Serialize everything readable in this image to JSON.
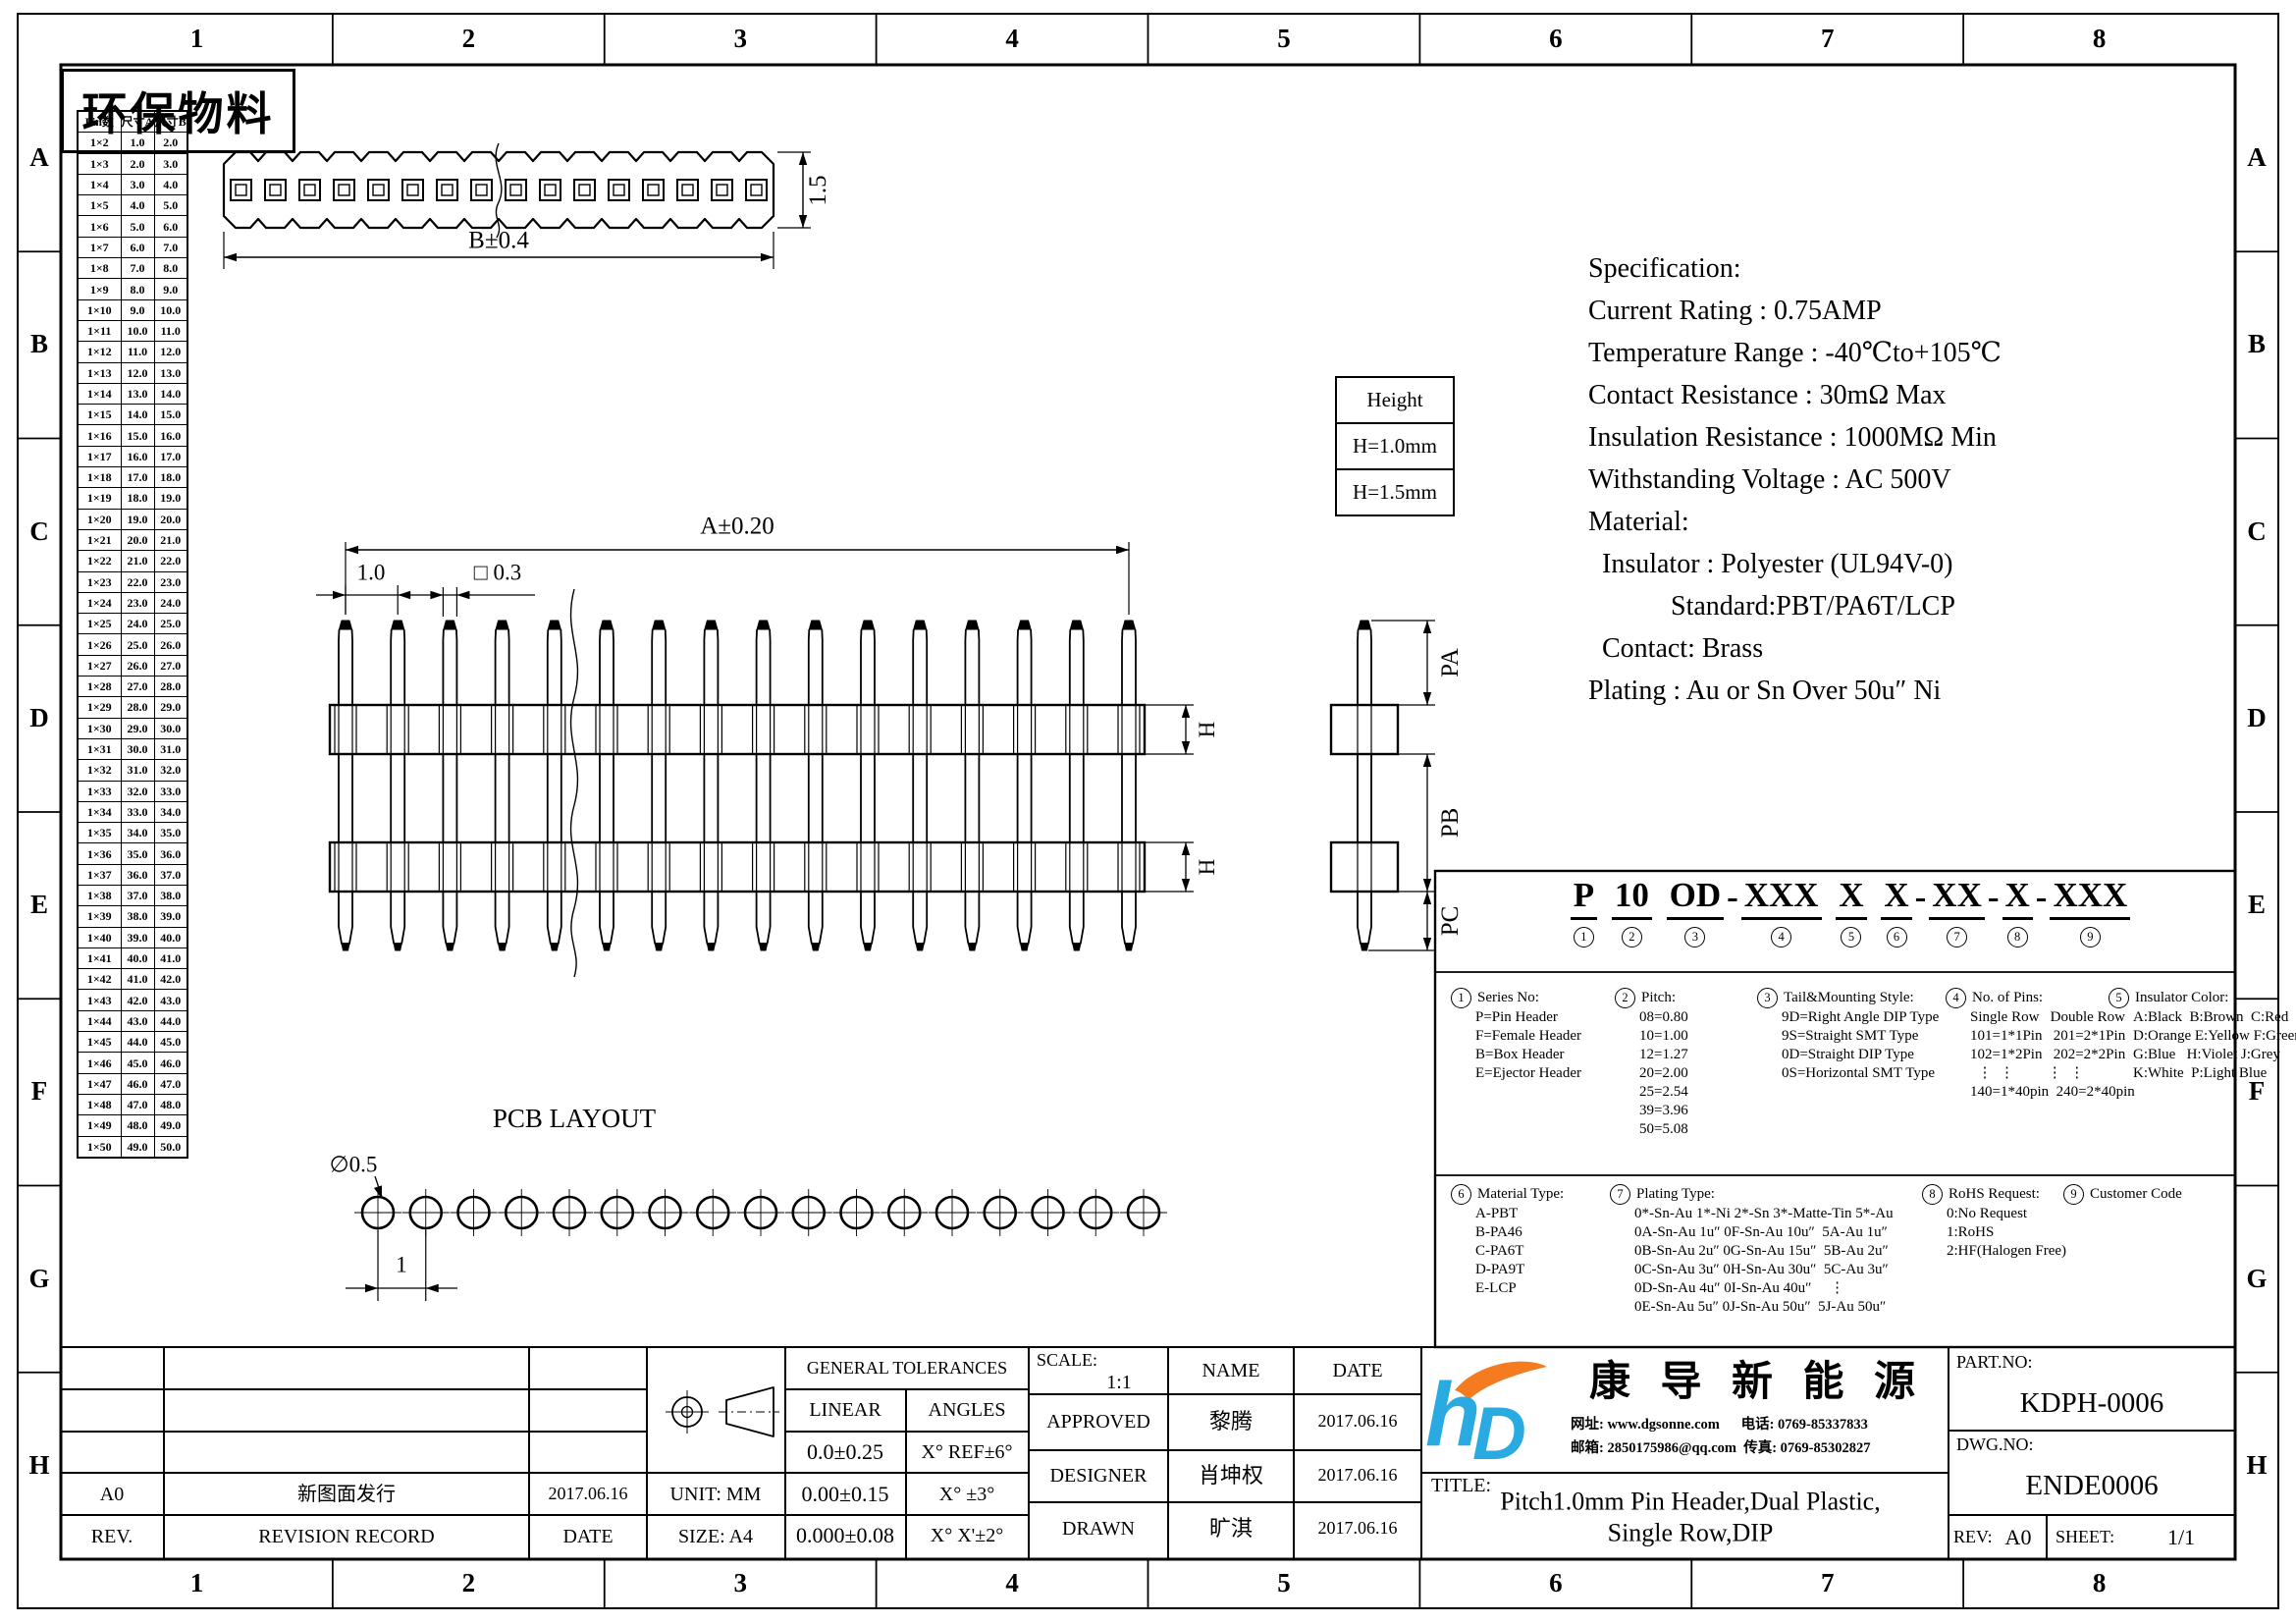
{
  "sheet": {
    "eco_label": "环保物料",
    "zone_cols": [
      "1",
      "2",
      "3",
      "4",
      "5",
      "6",
      "7",
      "8"
    ],
    "zone_rows": [
      "A",
      "B",
      "C",
      "D",
      "E",
      "F",
      "G",
      "H"
    ]
  },
  "dimension_table": {
    "headers": [
      "Pin数",
      "尺寸A",
      "尺寸B"
    ],
    "rows": [
      [
        "1×2",
        "1.0",
        "2.0"
      ],
      [
        "1×3",
        "2.0",
        "3.0"
      ],
      [
        "1×4",
        "3.0",
        "4.0"
      ],
      [
        "1×5",
        "4.0",
        "5.0"
      ],
      [
        "1×6",
        "5.0",
        "6.0"
      ],
      [
        "1×7",
        "6.0",
        "7.0"
      ],
      [
        "1×8",
        "7.0",
        "8.0"
      ],
      [
        "1×9",
        "8.0",
        "9.0"
      ],
      [
        "1×10",
        "9.0",
        "10.0"
      ],
      [
        "1×11",
        "10.0",
        "11.0"
      ],
      [
        "1×12",
        "11.0",
        "12.0"
      ],
      [
        "1×13",
        "12.0",
        "13.0"
      ],
      [
        "1×14",
        "13.0",
        "14.0"
      ],
      [
        "1×15",
        "14.0",
        "15.0"
      ],
      [
        "1×16",
        "15.0",
        "16.0"
      ],
      [
        "1×17",
        "16.0",
        "17.0"
      ],
      [
        "1×18",
        "17.0",
        "18.0"
      ],
      [
        "1×19",
        "18.0",
        "19.0"
      ],
      [
        "1×20",
        "19.0",
        "20.0"
      ],
      [
        "1×21",
        "20.0",
        "21.0"
      ],
      [
        "1×22",
        "21.0",
        "22.0"
      ],
      [
        "1×23",
        "22.0",
        "23.0"
      ],
      [
        "1×24",
        "23.0",
        "24.0"
      ],
      [
        "1×25",
        "24.0",
        "25.0"
      ],
      [
        "1×26",
        "25.0",
        "26.0"
      ],
      [
        "1×27",
        "26.0",
        "27.0"
      ],
      [
        "1×28",
        "27.0",
        "28.0"
      ],
      [
        "1×29",
        "28.0",
        "29.0"
      ],
      [
        "1×30",
        "29.0",
        "30.0"
      ],
      [
        "1×31",
        "30.0",
        "31.0"
      ],
      [
        "1×32",
        "31.0",
        "32.0"
      ],
      [
        "1×33",
        "32.0",
        "33.0"
      ],
      [
        "1×34",
        "33.0",
        "34.0"
      ],
      [
        "1×35",
        "34.0",
        "35.0"
      ],
      [
        "1×36",
        "35.0",
        "36.0"
      ],
      [
        "1×37",
        "36.0",
        "37.0"
      ],
      [
        "1×38",
        "37.0",
        "38.0"
      ],
      [
        "1×39",
        "38.0",
        "39.0"
      ],
      [
        "1×40",
        "39.0",
        "40.0"
      ],
      [
        "1×41",
        "40.0",
        "41.0"
      ],
      [
        "1×42",
        "41.0",
        "42.0"
      ],
      [
        "1×43",
        "42.0",
        "43.0"
      ],
      [
        "1×44",
        "43.0",
        "44.0"
      ],
      [
        "1×45",
        "44.0",
        "45.0"
      ],
      [
        "1×46",
        "45.0",
        "46.0"
      ],
      [
        "1×47",
        "46.0",
        "47.0"
      ],
      [
        "1×48",
        "47.0",
        "48.0"
      ],
      [
        "1×49",
        "48.0",
        "49.0"
      ],
      [
        "1×50",
        "49.0",
        "50.0"
      ]
    ]
  },
  "height_table": {
    "title": "Height",
    "rows": [
      "H=1.0mm",
      "H=1.5mm"
    ]
  },
  "top_view": {
    "dim_width": "B±0.4",
    "dim_height": "1.5"
  },
  "front_view": {
    "dim_overall": "A±0.20",
    "dim_pitch": "1.0",
    "dim_pin": "□ 0.3",
    "dim_h": "H"
  },
  "side_view": {
    "pa": "PA",
    "pb": "PB",
    "pc": "PC"
  },
  "pcb_layout": {
    "title": "PCB LAYOUT",
    "hole_dia": "∅0.5",
    "hole_pitch": "1"
  },
  "spec": {
    "lines": [
      "Specification:",
      "Current Rating : 0.75AMP",
      "Temperature Range : -40℃to+105℃",
      "Contact Resistance : 30mΩ Max",
      "Insulation Resistance : 1000MΩ Min",
      "Withstanding Voltage : AC 500V",
      "Material:",
      "  Insulator : Polyester (UL94V-0)",
      "            Standard:PBT/PA6T/LCP",
      "  Contact: Brass",
      "Plating : Au or Sn Over 50u″ Ni"
    ]
  },
  "part_number": {
    "segments": [
      {
        "t": "P",
        "n": "1"
      },
      {
        "t": "10",
        "n": "2",
        "pre": " "
      },
      {
        "t": "OD",
        "n": "3",
        "pre": " "
      },
      {
        "t": "XXX",
        "n": "4",
        "pre": "-"
      },
      {
        "t": "X",
        "n": "5",
        "pre": " "
      },
      {
        "t": "X",
        "n": "6",
        "pre": " "
      },
      {
        "t": "XX",
        "n": "7",
        "pre": "-"
      },
      {
        "t": "X",
        "n": "8",
        "pre": "-"
      },
      {
        "t": "XXX",
        "n": "9",
        "pre": "-"
      }
    ],
    "legend1": [
      {
        "num": "1",
        "title": "Series No:",
        "lines": [
          "P=Pin Header",
          "F=Female Header",
          "B=Box Header",
          "E=Ejector Header"
        ]
      },
      {
        "num": "2",
        "title": "Pitch:",
        "lines": [
          "08=0.80",
          "10=1.00",
          "12=1.27",
          "20=2.00",
          "25=2.54",
          "39=3.96",
          "50=5.08"
        ]
      },
      {
        "num": "3",
        "title": "Tail&Mounting Style:",
        "lines": [
          "9D=Right Angle DIP Type",
          "9S=Straight SMT Type",
          "0D=Straight DIP Type",
          "0S=Horizontal SMT Type"
        ]
      },
      {
        "num": "4",
        "title": "No. of Pins:",
        "lines": [
          "Single Row   Double Row",
          "101=1*1Pin   201=2*1Pin",
          "102=1*2Pin   202=2*2Pin",
          "  ⋮  ⋮         ⋮  ⋮",
          "140=1*40pin  240=2*40pin"
        ]
      },
      {
        "num": "5",
        "title": "Insulator Color:",
        "lines": [
          "A:Black  B:Brown  C:Red",
          "D:Orange E:Yellow F:Green",
          "G:Blue   H:Violet J:Grey",
          "K:White  P:Light Blue"
        ]
      }
    ],
    "legend2": [
      {
        "num": "6",
        "title": "Material Type:",
        "lines": [
          "A-PBT",
          "B-PA46",
          "C-PA6T",
          "D-PA9T",
          "E-LCP"
        ]
      },
      {
        "num": "7",
        "title": "Plating Type:",
        "lines": [
          "0*-Sn-Au 1*-Ni 2*-Sn 3*-Matte-Tin 5*-Au",
          "0A-Sn-Au 1u″ 0F-Sn-Au 10u″  5A-Au 1u″",
          "0B-Sn-Au 2u″ 0G-Sn-Au 15u″  5B-Au 2u″",
          "0C-Sn-Au 3u″ 0H-Sn-Au 30u″  5C-Au 3u″",
          "0D-Sn-Au 4u″ 0I-Sn-Au 40u″     ⋮",
          "0E-Sn-Au 5u″ 0J-Sn-Au 50u″  5J-Au 50u″"
        ]
      },
      {
        "num": "8",
        "title": "RoHS Request:",
        "lines": [
          "0:No Request",
          "1:RoHS",
          "2:HF(Halogen Free)"
        ]
      },
      {
        "num": "9",
        "title": "Customer Code",
        "lines": []
      }
    ]
  },
  "title_block": {
    "revision": {
      "rev": "A0",
      "record": "新图面发行",
      "date": "2017.06.16",
      "rev_header": "REV.",
      "record_header": "REVISION RECORD",
      "date_header": "DATE"
    },
    "unit": "UNIT: MM",
    "size": "SIZE: A4",
    "tolerances": {
      "title": "GENERAL TOLERANCES",
      "linear": "LINEAR",
      "angles": "ANGLES",
      "rows": [
        [
          "0.0±0.25",
          "X° REF±6°"
        ],
        [
          "0.00±0.15",
          "X° ±3°"
        ],
        [
          "0.000±0.08",
          "X° X'±2°"
        ]
      ]
    },
    "approval": {
      "scale_label": "SCALE:",
      "scale": "1:1",
      "name": "NAME",
      "date": "DATE",
      "rows": [
        [
          "APPROVED",
          "黎腾",
          "2017.06.16"
        ],
        [
          "DESIGNER",
          "肖坤权",
          "2017.06.16"
        ],
        [
          "DRAWN",
          "旷淇",
          "2017.06.16"
        ]
      ]
    },
    "company": {
      "name": "康 导 新 能 源",
      "contact1": "网址: www.dgsonne.com      电话: 0769-85337833",
      "contact2": "邮箱: 2850175986@qq.com  传真: 0769-85302827"
    },
    "title": {
      "label": "TITLE:",
      "line1": "Pitch1.0mm Pin Header,Dual Plastic,",
      "line2": "Single Row,DIP"
    },
    "part": {
      "no_label": "PART.NO:",
      "no": "KDPH-0006",
      "dwg_label": "DWG.NO:",
      "dwg": "ENDE0006",
      "rev_label": "REV:",
      "rev": "A0",
      "sheet_label": "SHEET:",
      "sheet": "1/1"
    }
  }
}
